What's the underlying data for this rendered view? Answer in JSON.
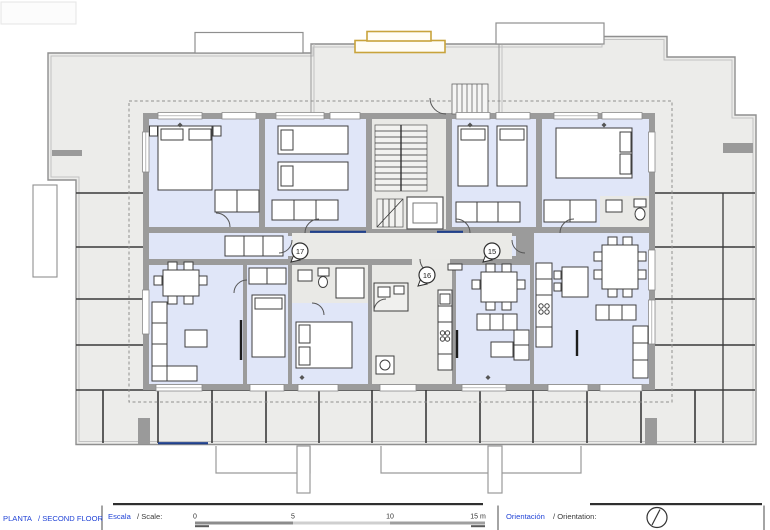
{
  "title_block": {
    "floor_label_es": "PLANTA",
    "floor_label_en": "/ SECOND FLOOR",
    "scale_label_es": "Escala",
    "scale_label_en": "/ Scale:",
    "scale_ticks": [
      "0",
      "5",
      "10",
      "15 m"
    ],
    "orientation_label_es": "Orientación",
    "orientation_label_en": "/ Orientation:"
  },
  "units": [
    {
      "number": "17"
    },
    {
      "number": "16"
    },
    {
      "number": "15"
    }
  ],
  "colors": {
    "room_fill": "#e0e6f8",
    "service_fill": "#e9e9e6",
    "wall_gray": "#9b9b9b",
    "roof_fill": "#ececea",
    "accent_yellow": "#c8a33c",
    "label_blue": "#2244d6",
    "section_navy": "#20418c"
  }
}
